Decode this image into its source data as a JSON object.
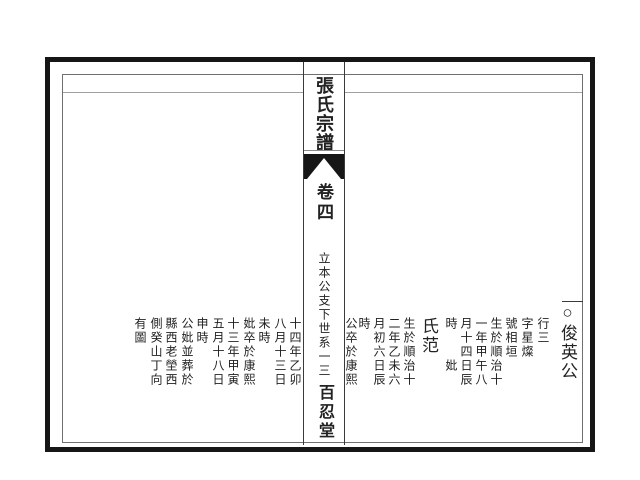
{
  "center_column": {
    "title": "張氏宗譜",
    "volume": "卷四",
    "section": "立本公支下世系",
    "page_number": "一三",
    "hall": "百忍堂",
    "fishtail_mark": "fishtail-printers-mark"
  },
  "right_page": {
    "entry_name": "○俊英公",
    "consort": "氏范",
    "columns": [
      "行三",
      "字星燦",
      "號相垣",
      "生於順治十",
      "一年甲午八",
      "月十四日辰",
      "時　　妣",
      "生於順治十",
      "二年乙未六",
      "月初六日辰",
      "時",
      "公卒於康熙"
    ]
  },
  "left_page": {
    "columns": [
      "十四年乙卯",
      "八月十三日",
      "未時",
      "妣卒於康熙",
      "十三年甲寅",
      "五月十八日",
      "申時",
      "公妣並葬於",
      "縣西老塋西",
      "側癸山丁向",
      "有圖"
    ]
  },
  "colors": {
    "frame": "#161616",
    "text": "#222222",
    "background": "#ffffff"
  }
}
